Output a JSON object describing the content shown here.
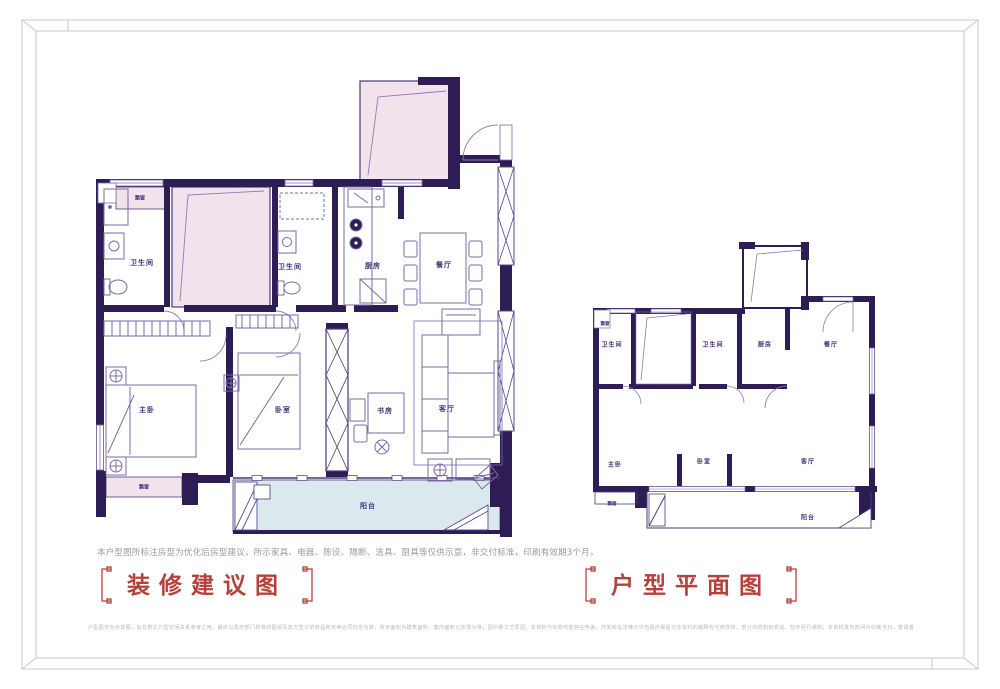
{
  "page": {
    "note": "本户型图所标注房型为优化后房型建议，所示家具、电器、陈设、隔断、洁具、厨具等仅供示意，非交付标准，印刷有效期3个月。",
    "disclaimer": "户型图仅为示意图，旨在表达户型空间关系参考之用，最终以政府部门核准的图纸及双方签订的商品房买卖合同约定为准；所示面积为建筑面积，套内面积以实测为准；因印刷工艺原因，本资料与实物可能存在色差；开发商在法律允许范围内保留对本资料的解释权与修改权；部分内容如有变动，恕不另行通知；本资料发布时间为印刷当日，敬请垂询最新信息，最终解释权归开发商所有。",
    "colors": {
      "wall": "#2e1c55",
      "thin_line": "#7b6ba8",
      "pink": "#f2e2ec",
      "blue": "#dbe9ef",
      "accent_red": "#b5413a"
    }
  },
  "decorated_plan": {
    "title": "装修建议图",
    "rooms": {
      "bay_window_top": "飘窗",
      "bathroom_1": "卫生间",
      "bathroom_2": "卫生间",
      "kitchen": "厨房",
      "dining": "餐厅",
      "master_bedroom": "主卧",
      "bedroom": "卧室",
      "study": "书房",
      "living": "客厅",
      "bay_window_bottom": "飘窗",
      "balcony": "阳台"
    }
  },
  "layout_plan": {
    "title": "户型平面图",
    "rooms": {
      "bay_window_top": "飘窗",
      "bathroom_1": "卫生间",
      "bathroom_2": "卫生间",
      "kitchen": "厨房",
      "dining": "餐厅",
      "master_bedroom": "主卧",
      "bedroom": "卧室",
      "living": "客厅",
      "bay_window_bottom": "飘窗",
      "balcony": "阳台"
    }
  }
}
